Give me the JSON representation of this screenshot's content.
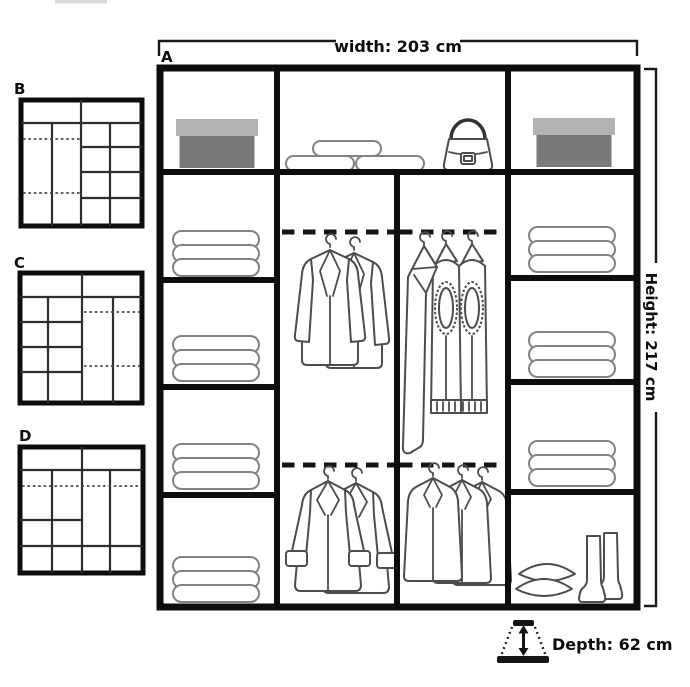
{
  "diagram": {
    "main": {
      "label": "A",
      "width_label": "width: 203 cm",
      "height_label": "Height: 217 cm",
      "depth_label": "Depth: 62 cm",
      "contents": {
        "top_shelf": [
          "storage-box",
          "folded-blankets",
          "handbag",
          "storage-box"
        ],
        "left_column": [
          "folded-clothes-stack",
          "folded-clothes-stack",
          "folded-clothes-stack",
          "folded-clothes-stack"
        ],
        "middle_left_sections": [
          "hanging-jackets",
          "hanging-coats"
        ],
        "middle_right_sections": [
          "hanging-trousers",
          "hanging-overcoats"
        ],
        "right_column": [
          "folded-clothes-stack",
          "folded-clothes-stack",
          "folded-clothes-stack",
          "pillows-and-boots"
        ]
      }
    },
    "variants": [
      {
        "label": "B"
      },
      {
        "label": "C"
      },
      {
        "label": "D"
      }
    ],
    "colors": {
      "line": "#0d0d0d",
      "clothes_outline": "#4d4d4d",
      "box_lid": "#b3b3b3",
      "box_body": "#7a7a7a"
    }
  }
}
